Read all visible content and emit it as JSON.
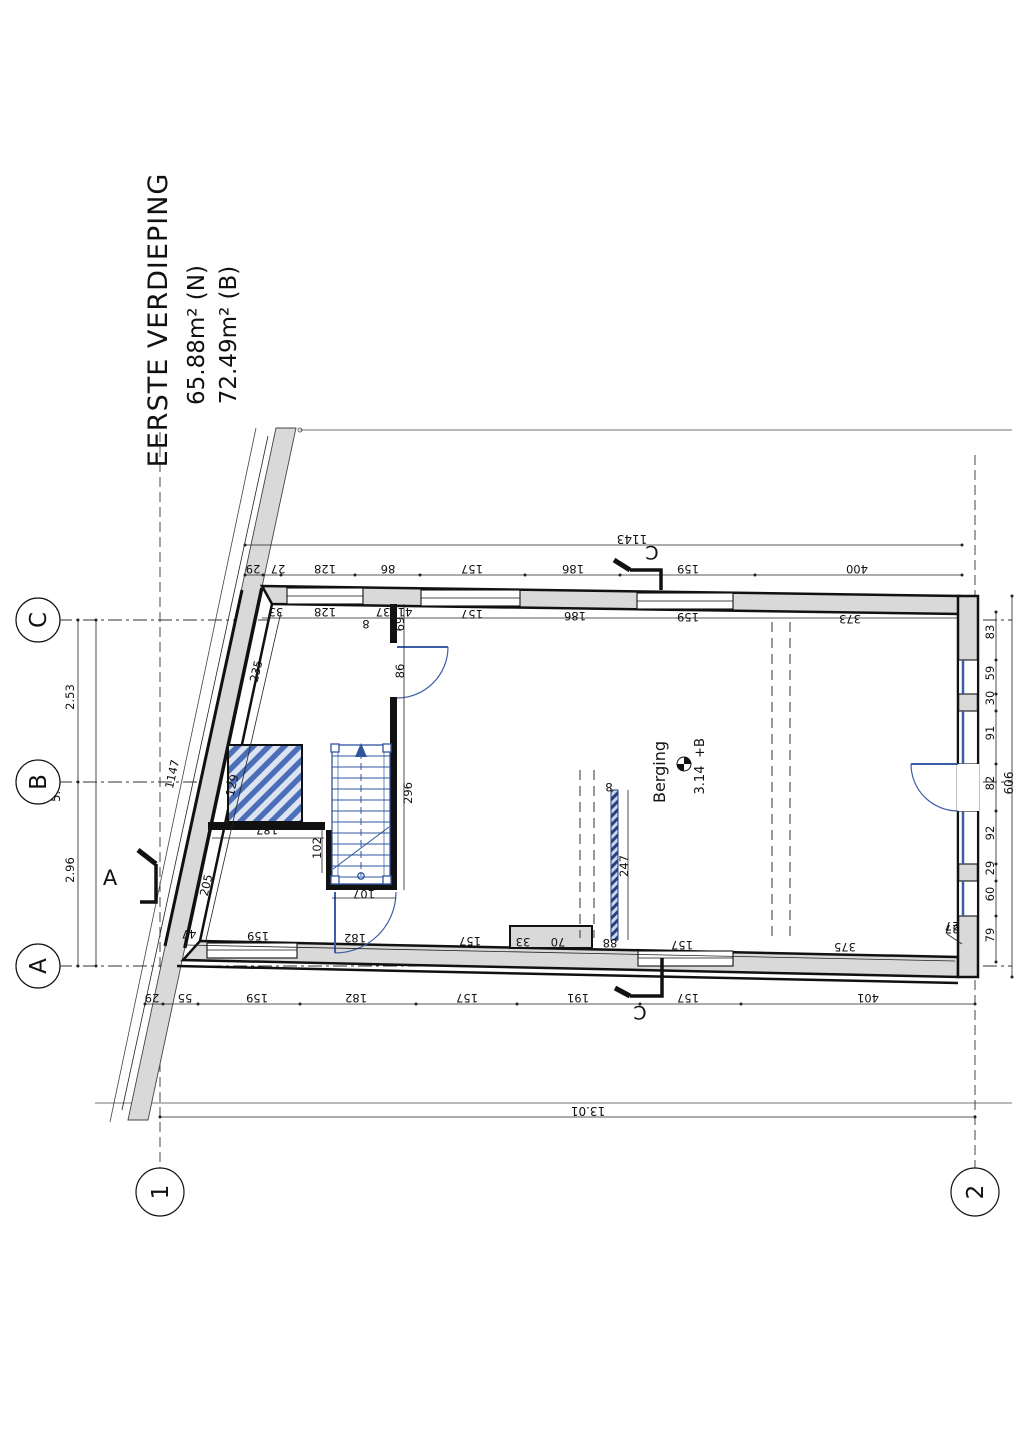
{
  "title": {
    "line1": "EERSTE VERDIEPING",
    "line2": "65.88m² (N)",
    "line3": "72.49m² (B)"
  },
  "grid": {
    "row_c": "C",
    "row_b": "B",
    "row_a": "A",
    "col_1": "1",
    "col_2": "2",
    "dim_cb": "2.53",
    "dim_ba": "2.96",
    "dim_rows_total": "5.49",
    "dim_cols_total": "13.01"
  },
  "room": {
    "name": "Berging",
    "area": "3.14",
    "level": "+B"
  },
  "sections": {
    "top": "C",
    "bottom": "C",
    "left": "A"
  },
  "dims": {
    "overall_top": "1143",
    "slant_total": "1147",
    "top_outer": [
      "29",
      "27",
      "128",
      "86",
      "157",
      "186",
      "159",
      "400"
    ],
    "top_inner": [
      "33",
      "128",
      "37",
      "41",
      "157",
      "186",
      "159",
      "373"
    ],
    "bottom_inner": [
      "47",
      "159",
      "182",
      "157",
      "33",
      "70",
      "88",
      "157",
      "375",
      "27"
    ],
    "bottom_outer": [
      "29",
      "55",
      "159",
      "182",
      "157",
      "191",
      "157",
      "401"
    ],
    "right_chain": [
      "83",
      "59",
      "30",
      "91",
      "82",
      "92",
      "29",
      "60",
      "79"
    ],
    "right_total": "606",
    "right_corner": "27",
    "slant_side": [
      "235",
      "205"
    ],
    "interior": {
      "hatch": "129",
      "wall187": "187",
      "stair102": "102",
      "stair107": "107",
      "t8": "8",
      "d69": "69",
      "door86": "86",
      "wall296": "296",
      "part247": "247",
      "part8": "8"
    }
  },
  "colors": {
    "wall_fill": "#d9d9d9",
    "line": "#111111",
    "blue": "#3c5ca8",
    "hatch_blue": "#4a6fb8"
  }
}
